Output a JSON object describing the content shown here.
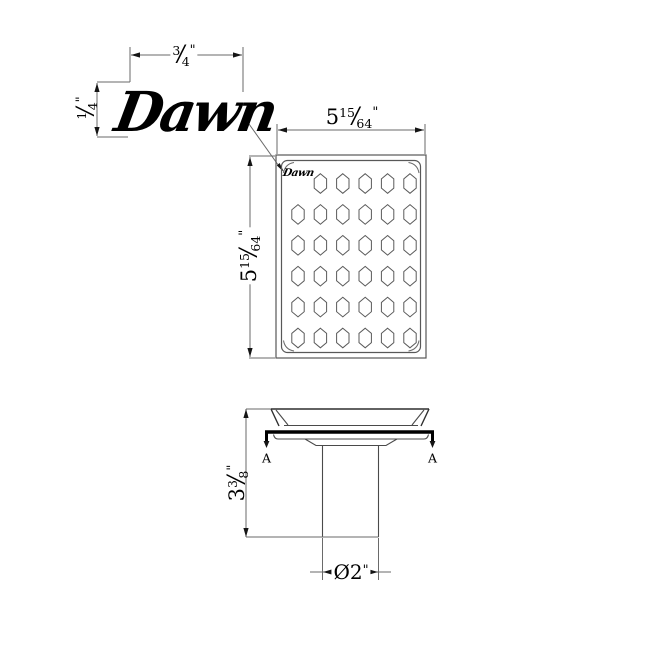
{
  "drawing": {
    "brand_logo": "Dawn",
    "plate_logo": "Dawn",
    "labels": {
      "section_left": "A",
      "section_right": "A"
    },
    "dimensions": {
      "logo_width": {
        "num": "3",
        "den": "4",
        "unit": "\""
      },
      "logo_height": {
        "num": "1",
        "den": "4",
        "unit": "\""
      },
      "plate_width": {
        "whole": "5",
        "num": "15",
        "den": "64",
        "unit": "\""
      },
      "plate_height": {
        "whole": "5",
        "num": "15",
        "den": "64",
        "unit": "\""
      },
      "body_height": {
        "whole": "3",
        "num": "3",
        "den": "8",
        "unit": "\""
      },
      "outlet_diameter": {
        "prefix": "Ø",
        "whole": "2",
        "unit": "\""
      }
    },
    "grate": {
      "rows": 6,
      "cols": 6,
      "hole_shape": "hexagon",
      "holes": 35
    }
  },
  "colors": {
    "background": "#ffffff",
    "thin_line": "#6a6a6a",
    "outline": "#2f2f2f",
    "section_line": "#000000"
  },
  "grid_spec": {
    "x0": 298,
    "y0": 183.5,
    "dx": 22.4,
    "dy": 30.9,
    "hw": 6.2,
    "hh": 9.8,
    "side": 4.6
  }
}
